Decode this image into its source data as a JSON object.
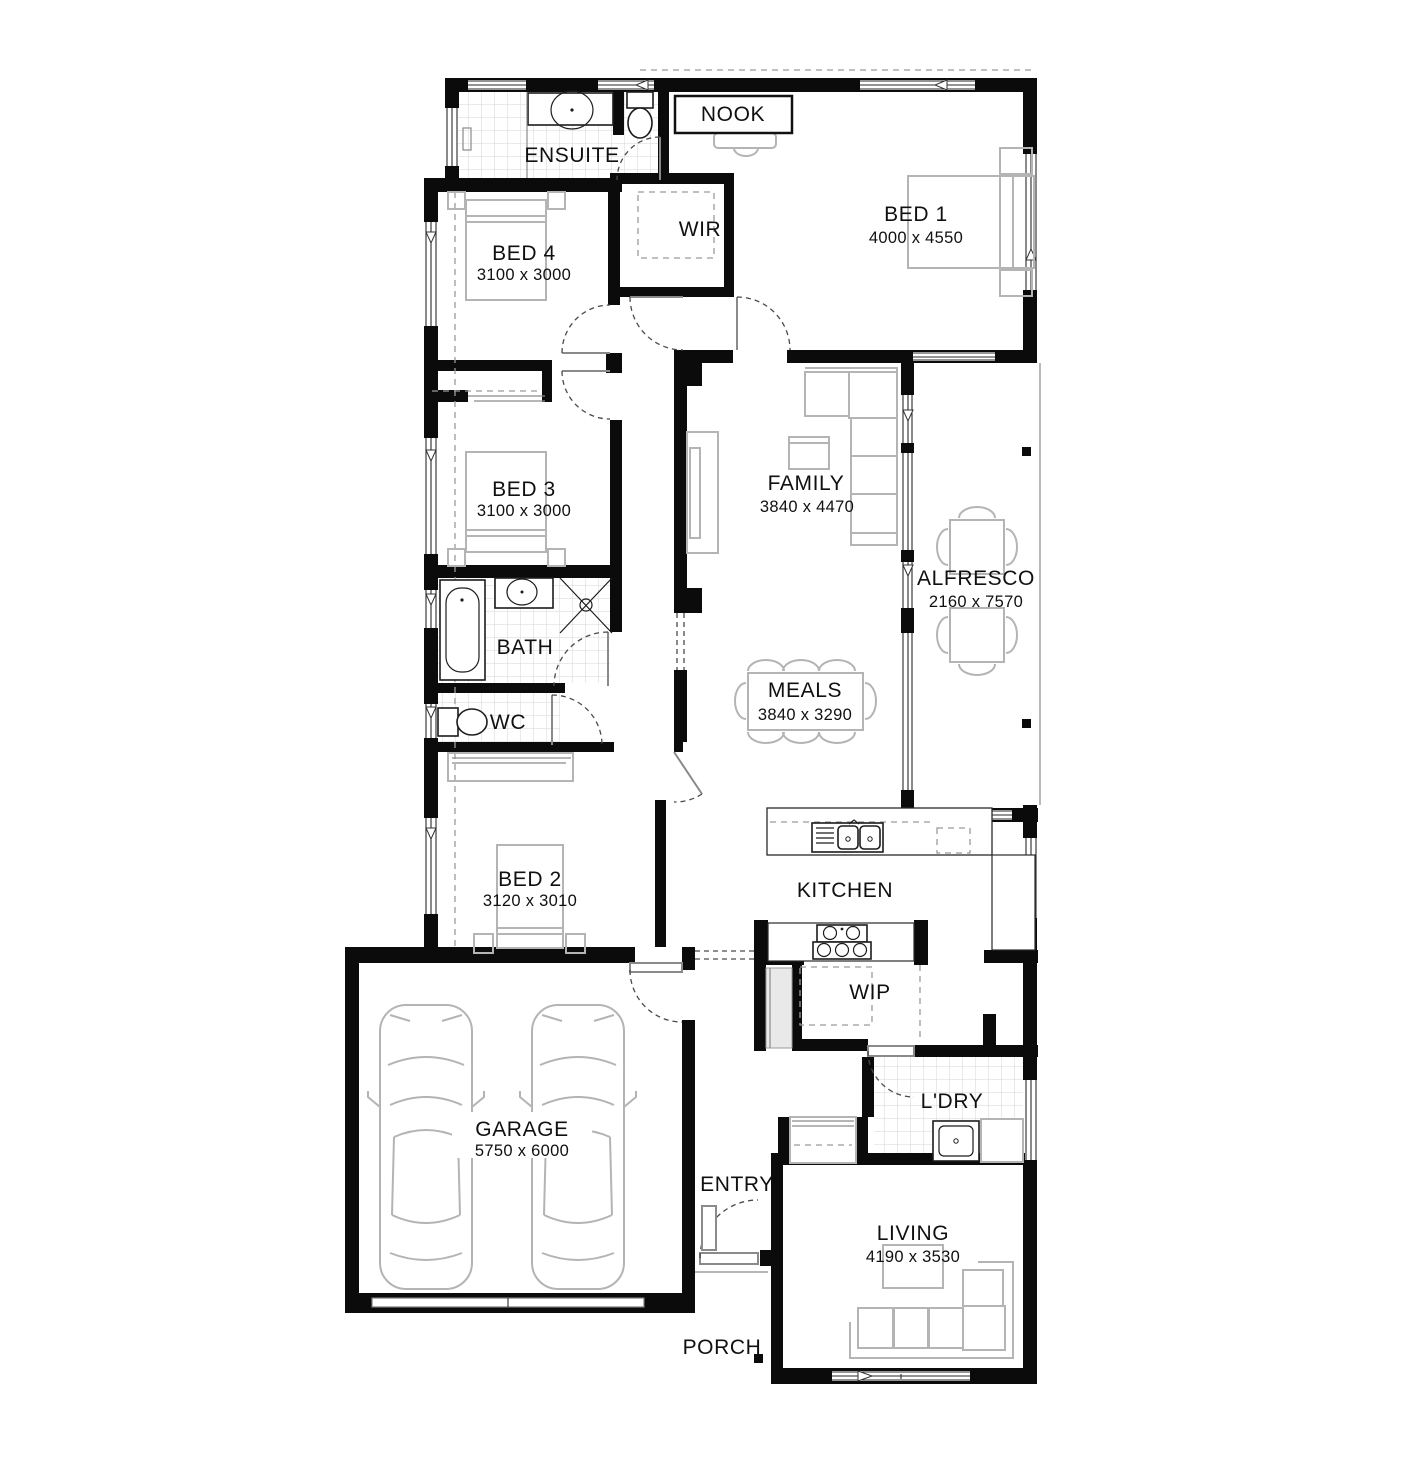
{
  "plan": {
    "type": "house-floor-plan",
    "background": "#ffffff",
    "wall_color": "#0b0b0b",
    "furniture_color": "#b4b4b4",
    "fixture_color": "#1c1c1c",
    "text_color": "#101010",
    "rooms": {
      "nook": {
        "label": "NOOK"
      },
      "ensuite": {
        "label": "ENSUITE"
      },
      "bed4": {
        "label": "BED 4",
        "dims": "3100 x 3000"
      },
      "wir": {
        "label": "WIR"
      },
      "bed1": {
        "label": "BED 1",
        "dims": "4000 x 4550"
      },
      "bed3": {
        "label": "BED 3",
        "dims": "3100 x 3000"
      },
      "family": {
        "label": "FAMILY",
        "dims": "3840 x 4470"
      },
      "alfresco": {
        "label": "ALFRESCO",
        "dims": "2160 x 7570"
      },
      "bath": {
        "label": "BATH"
      },
      "meals": {
        "label": "MEALS",
        "dims": "3840 x 3290"
      },
      "wc": {
        "label": "WC"
      },
      "bed2": {
        "label": "BED 2",
        "dims": "3120 x 3010"
      },
      "kitchen": {
        "label": "KITCHEN"
      },
      "wip": {
        "label": "WIP"
      },
      "garage": {
        "label": "GARAGE",
        "dims": "5750 x 6000"
      },
      "entry": {
        "label": "ENTRY"
      },
      "ldry": {
        "label": "L'DRY"
      },
      "living": {
        "label": "LIVING",
        "dims": "4190 x 3530"
      },
      "porch": {
        "label": "PORCH"
      }
    }
  }
}
